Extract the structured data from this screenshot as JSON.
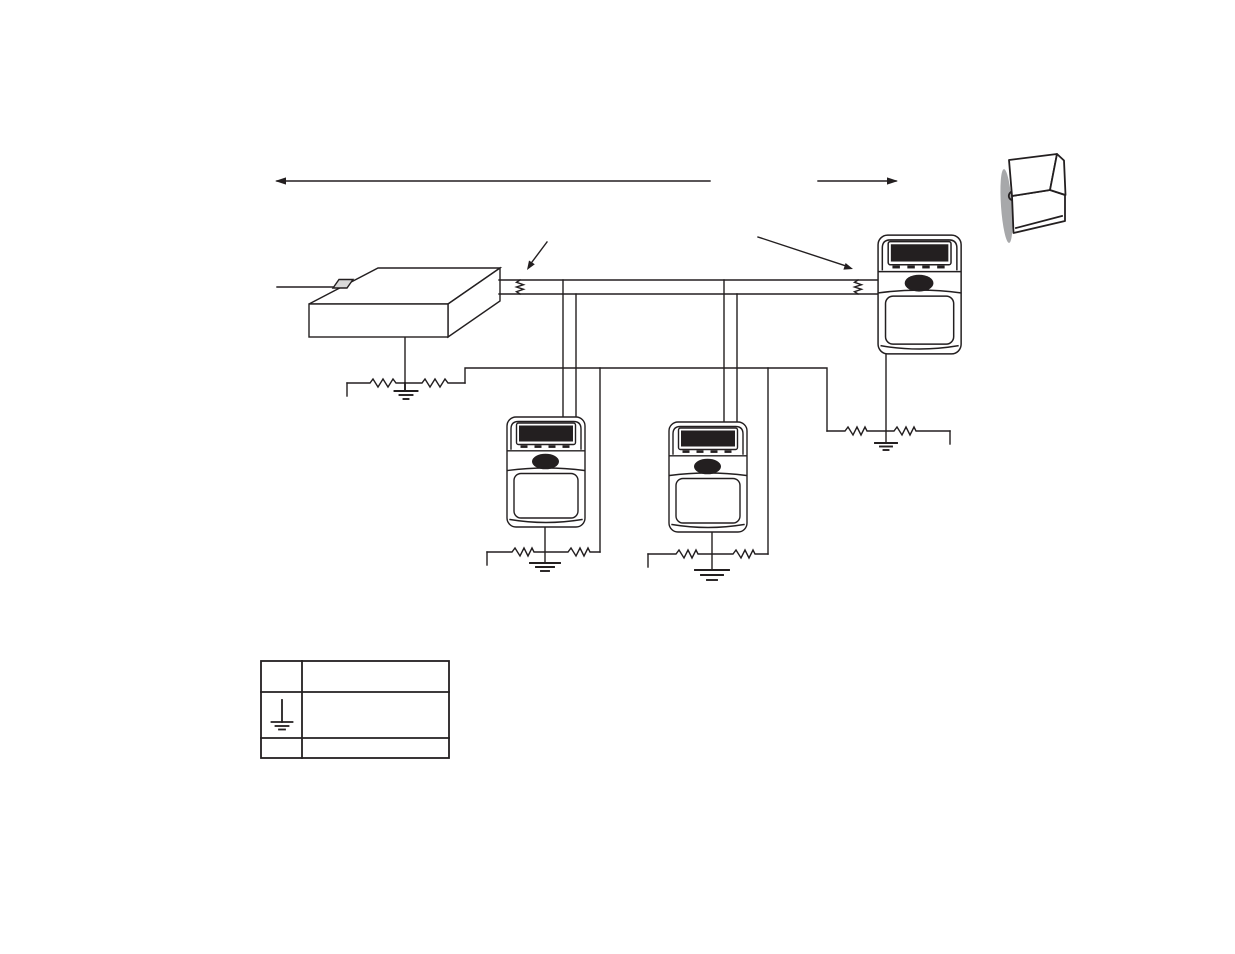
{
  "page": {
    "background_color": "#ffffff",
    "line_color": "#231f20",
    "display_color": "#231f20",
    "shadow_color": "#98999b",
    "visible_text": ""
  },
  "diagram": {
    "type": "device-network-wiring-schematic",
    "components": [
      {
        "id": "host-controller",
        "shape": "isometric-box",
        "connections": [
          "host-wire-left",
          "two-wire-bus",
          "earth-ground-with-resistors"
        ]
      },
      {
        "id": "terminal-1",
        "shape": "keypad-terminal",
        "features": [
          "dark-display",
          "four-buttons",
          "speaker-oval",
          "keypad-panel"
        ],
        "connections": [
          "bus-drop-pair",
          "earth-ground-with-resistors"
        ]
      },
      {
        "id": "terminal-2",
        "shape": "keypad-terminal",
        "features": [
          "dark-display",
          "four-buttons",
          "speaker-oval",
          "keypad-panel"
        ],
        "connections": [
          "bus-drop-pair",
          "earth-ground-with-resistors"
        ]
      },
      {
        "id": "terminal-3",
        "shape": "keypad-terminal",
        "features": [
          "dark-display",
          "four-buttons",
          "speaker-oval",
          "keypad-panel"
        ],
        "connections": [
          "bus-direct-side",
          "earth-ground-with-resistors"
        ]
      }
    ],
    "bus": {
      "wires": 2,
      "termination_resistors": [
        "left-end-vertical-zigzag",
        "right-end-vertical-zigzag"
      ],
      "callout_arrows": [
        "arrow-to-left-termination",
        "arrow-to-right-termination"
      ]
    },
    "shield_rail": {
      "shape": "wire",
      "taps": 4
    },
    "earth_ground_symbols": 4,
    "ground_line_resistors": 8,
    "dimension_arrows": {
      "left_arrow_label": "",
      "right_arrow_label": ""
    }
  },
  "legend_table": {
    "columns": [
      "symbol",
      "description"
    ],
    "rows": [
      {
        "symbol": "",
        "description": ""
      },
      {
        "symbol": "earth-ground",
        "description": ""
      },
      {
        "symbol": "",
        "description": ""
      }
    ]
  },
  "corner_icon": {
    "name": "page-turn-open-book",
    "label": ""
  }
}
